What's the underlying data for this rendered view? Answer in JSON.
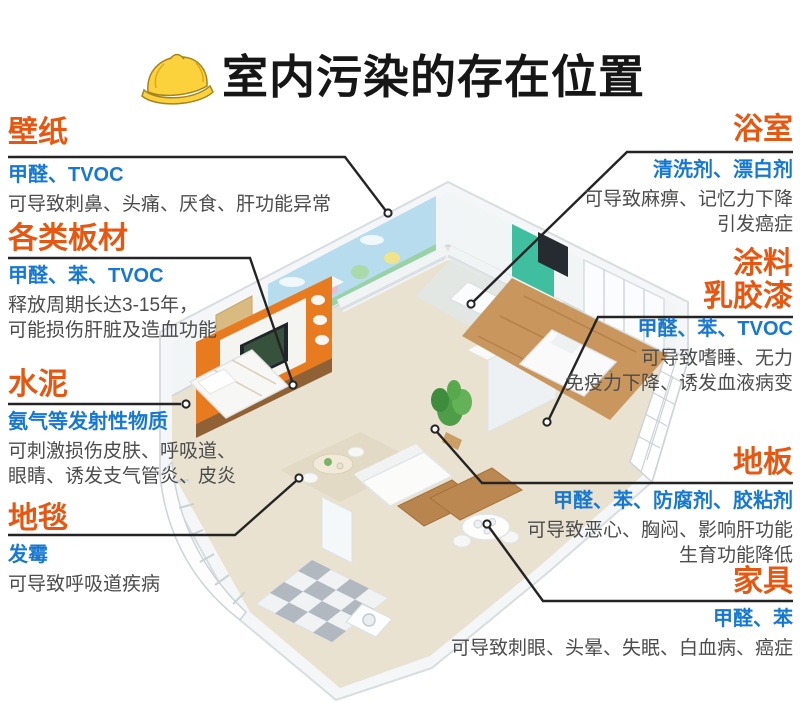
{
  "title": "室内污染的存在位置",
  "colors": {
    "accent_orange": "#e65712",
    "accent_blue": "#1778d2",
    "body_text": "#4c4c4c",
    "connector_line": "#242424",
    "hat_yellow": "#fcd23c"
  },
  "icons": {
    "header_icon": "hard-hat-icon"
  },
  "labels": {
    "left": [
      {
        "id": "wallpaper",
        "title": "壁纸",
        "pollutants": "甲醛、TVOC",
        "effects": [
          "可导致刺鼻、头痛、厌食、肝功能异常"
        ]
      },
      {
        "id": "boards",
        "title": "各类板材",
        "pollutants": "甲醛、苯、TVOC",
        "effects": [
          "释放周期长达3-15年，",
          "可能损伤肝脏及造血功能"
        ]
      },
      {
        "id": "cement",
        "title": "水泥",
        "pollutants": "氨气等发射性物质",
        "effects": [
          "可刺激损伤皮肤、呼吸道、",
          "眼睛、诱发支气管炎、皮炎"
        ]
      },
      {
        "id": "carpet",
        "title": "地毯",
        "pollutants": "发霉",
        "effects": [
          "可导致呼吸道疾病"
        ]
      }
    ],
    "right": [
      {
        "id": "bathroom",
        "title": "浴室",
        "pollutants": "清洗剂、漂白剂",
        "effects": [
          "可导致麻痹、记忆力下降",
          "引发癌症"
        ]
      },
      {
        "id": "paint",
        "title_lines": [
          "涂料",
          "乳胶漆"
        ],
        "pollutants": "甲醛、苯、TVOC",
        "effects": [
          "可导致嗜睡、无力",
          "免疫力下降、诱发血液病变"
        ]
      },
      {
        "id": "floor",
        "title": "地板",
        "pollutants": "甲醛、苯、防腐剂、胶粘剂",
        "effects": [
          "可导致恶心、胸闷、影响肝功能",
          "生育功能降低"
        ]
      },
      {
        "id": "furniture",
        "title": "家具",
        "pollutants": "甲醛、苯",
        "effects": [
          "可导致刺眼、头晕、失眠、白血病、癌症"
        ]
      }
    ]
  }
}
